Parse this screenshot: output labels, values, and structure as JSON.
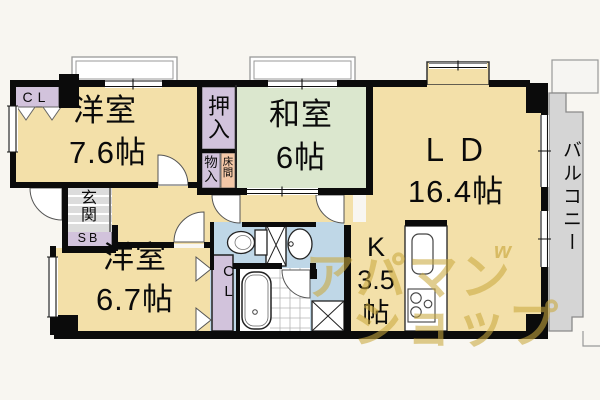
{
  "plan": {
    "rooms": {
      "western1": {
        "name": "洋室",
        "size": "7.6帖"
      },
      "western2": {
        "name": "洋室",
        "size": "6.7帖"
      },
      "japanese": {
        "name": "和室",
        "size": "6帖"
      },
      "living_dining": {
        "name": "ＬＤ",
        "size": "16.4帖"
      },
      "kitchen": {
        "name": "K",
        "size": "3.5",
        "unit": "帖"
      },
      "balcony": {
        "name": "バルコニー"
      },
      "entrance": {
        "name": "玄関"
      }
    },
    "storage": {
      "closet_upper": "CL",
      "closet_lower": "CL",
      "shoe_box": "SB",
      "oshiire": "押入",
      "monoire": "物入",
      "tokonoma": "床間"
    },
    "watermark": {
      "line1": "アパマン",
      "line2": "ショップ",
      "mark": "w"
    },
    "colors": {
      "wall": "#0B0B0B",
      "room_cream": "#F3E0A9",
      "tatami_green": "#DBE7CE",
      "closet_purple": "#D2C3DC",
      "tokonoma_pink": "#F4C8A7",
      "sanitary_blue": "#BFD7E7",
      "balcony_gray": "#D5D5D5",
      "entrance_gray": "#DCDCDC",
      "watermark_gold": "#C9A63E"
    }
  }
}
